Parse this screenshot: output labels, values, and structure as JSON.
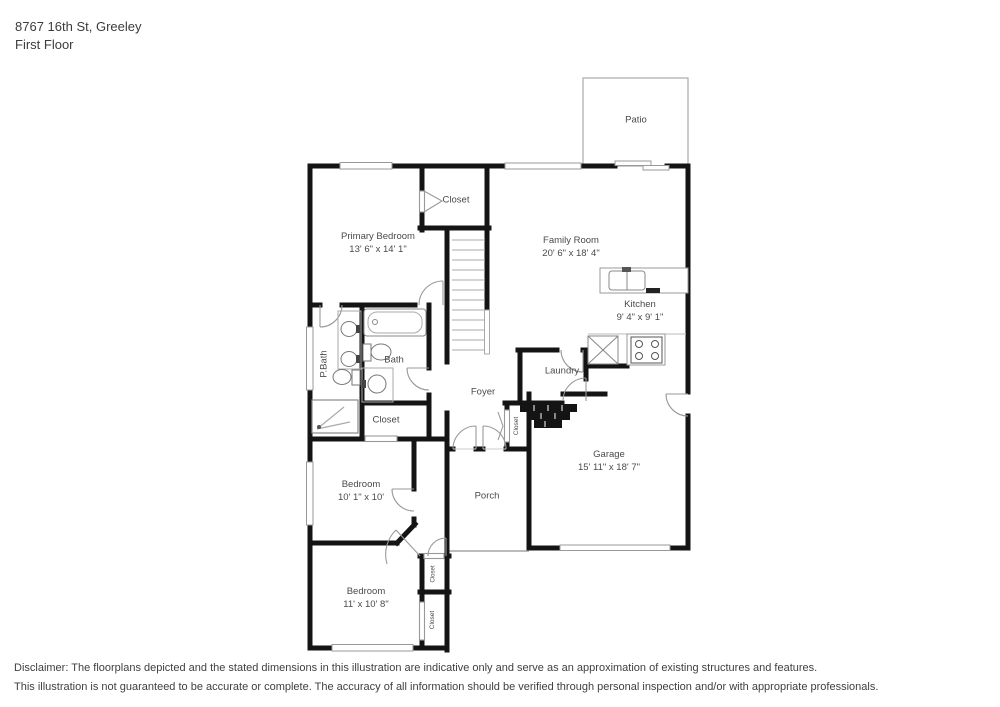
{
  "header": {
    "address": "8767 16th St, Greeley",
    "floor": "First Floor"
  },
  "floor_plan": {
    "rooms": {
      "patio": {
        "label": "Patio"
      },
      "closet_top": {
        "label": "Closet"
      },
      "primary_bedroom": {
        "label": "Primary Bedroom",
        "dims": "13' 6\" x 14' 1\""
      },
      "family_room": {
        "label": "Family Room",
        "dims": "20' 6\" x 18' 4\""
      },
      "kitchen": {
        "label": "Kitchen",
        "dims": "9' 4\" x 9' 1\""
      },
      "p_bath": {
        "label": "P.Bath"
      },
      "bath": {
        "label": "Bath"
      },
      "laundry": {
        "label": "Laundry"
      },
      "foyer": {
        "label": "Foyer"
      },
      "closet_hall": {
        "label": "Closet"
      },
      "closet_foyer": {
        "label": "Closet"
      },
      "garage": {
        "label": "Garage",
        "dims": "15' 11\" x 18' 7\""
      },
      "bedroom_middle": {
        "label": "Bedroom",
        "dims": "10' 1\" x 10'"
      },
      "porch": {
        "label": "Porch"
      },
      "bedroom_bottom": {
        "label": "Bedroom",
        "dims": "11' x 10' 8\""
      },
      "closet_small": {
        "label": "Closet"
      },
      "closet_bottom": {
        "label": "Closet"
      }
    }
  },
  "disclaimer": {
    "line1": "Disclaimer: The floorplans depicted and the stated dimensions in this illustration are indicative only and serve as an approximation of existing structures and features.",
    "line2": "This illustration is not guaranteed to be accurate or complete. The accuracy of all information should be verified through personal inspection and/or with appropriate professionals."
  },
  "colors": {
    "wall": "#141414",
    "thin_line": "#9a9a9a",
    "label_text": "#4a4a4a"
  }
}
